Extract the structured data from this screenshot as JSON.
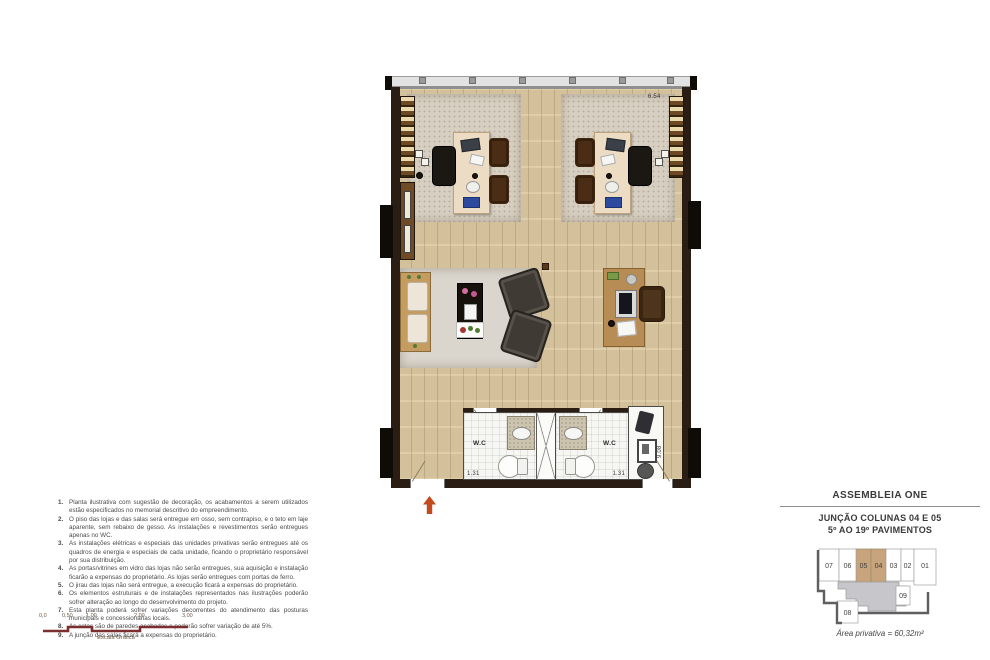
{
  "plan": {
    "dim_width": "6.54",
    "dim_depth": "9.08",
    "wc_label": "W.C",
    "wc_dim_left": "1.31",
    "wc_dim_right": "1.31"
  },
  "notes": {
    "items": [
      {
        "num": "1.",
        "text": "Planta ilustrativa com sugestão de decoração, os acabamentos a serem utilizados estão especificados no memorial descritivo do empreendimento."
      },
      {
        "num": "2.",
        "text": "O piso das lojas e das salas será entregue em osso, sem contrapiso, e o teto em laje aparente, sem rebaixo de gesso. As instalações e revestimentos serão entregues apenas no WC."
      },
      {
        "num": "3.",
        "text": "As instalações elétricas e especiais das unidades privativas serão entregues até os quadros de energia e especiais de cada unidade, ficando o proprietário responsável por sua distribuição."
      },
      {
        "num": "4.",
        "text": "As portas/vitrines em vidro das lojas não serão entregues, sua aquisição e instalação ficarão a expensas do proprietário. As lojas serão entregues com portas de ferro."
      },
      {
        "num": "5.",
        "text": "O jirau das lojas não será entregue, a execução ficará a expensas do proprietário."
      },
      {
        "num": "6.",
        "text": "Os elementos estruturais e de instalações representados nas ilustrações poderão sofrer alteração ao longo do desenvolvimento do projeto."
      },
      {
        "num": "7.",
        "text": "Esta planta poderá sofrer variações decorrentes do atendimento das posturas municipais e concessionárias locais."
      },
      {
        "num": "8.",
        "text": "As cotas são de paredes acabadas e poderão sofrer variação de até 5%."
      },
      {
        "num": "9.",
        "text": "A junção das salas ficará a expensas do proprietário."
      }
    ]
  },
  "scalebar": {
    "labels": [
      "0,0",
      "0,50",
      "1,00",
      "2,00",
      "3,00"
    ],
    "caption": "Escala Gráfica",
    "color": "#7b2f2f"
  },
  "panel": {
    "brand": "ASSEMBLEIA ONE",
    "line1": "JUNÇÃO COLUNAS 04 E 05",
    "line2": "5º AO 19º PAVIMENTOS",
    "area": "Área privativa = 60,32m²",
    "keyplan": {
      "units_row": [
        "07",
        "06",
        "05",
        "04",
        "03",
        "02",
        "01"
      ],
      "highlighted_units": [
        "05",
        "04"
      ],
      "unit_right": "09",
      "unit_bottom": "08",
      "highlight_color": "#c8a47c",
      "common_area_color": "#c7c7cb"
    }
  },
  "colors": {
    "entry_arrow": "#c24a1e",
    "wood_floor": "#dcc9a2",
    "wall": "#2a1d13"
  }
}
